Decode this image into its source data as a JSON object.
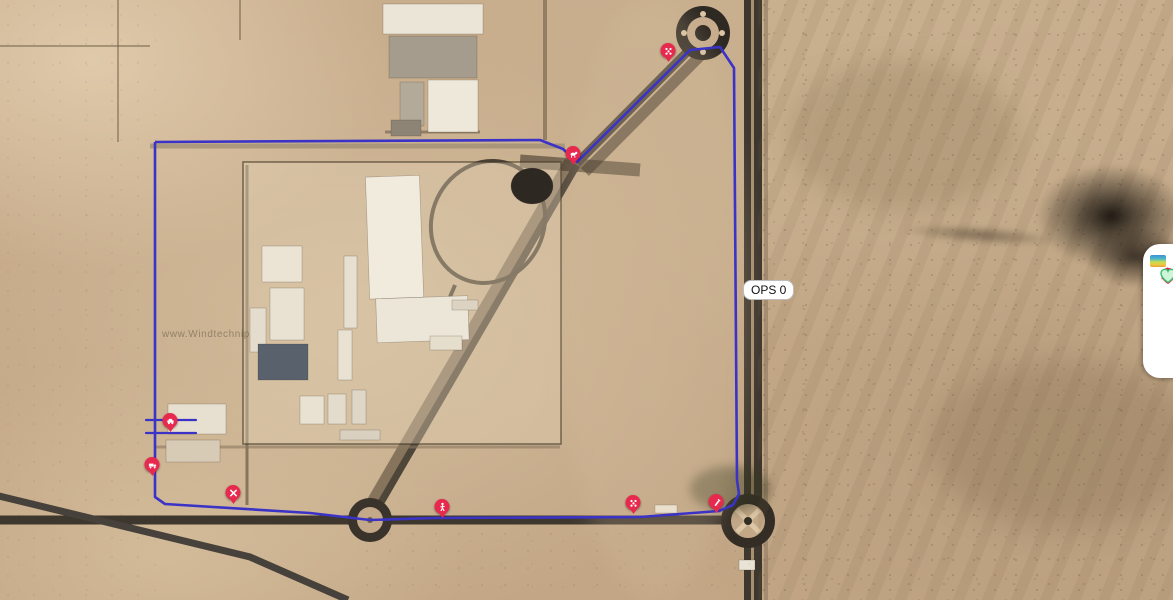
{
  "map": {
    "route_label": "OPS 0",
    "watermark": "www.Windtechnip",
    "route_color": "#3b33c6",
    "marker_color": "#e8294e",
    "route": {
      "loop": [
        [
          155,
          142
        ],
        [
          540,
          140
        ],
        [
          563,
          149
        ],
        [
          577,
          162
        ],
        [
          690,
          50
        ],
        [
          720,
          47
        ],
        [
          734,
          68
        ],
        [
          737,
          480
        ],
        [
          739,
          494
        ],
        [
          733,
          505
        ],
        [
          719,
          511
        ],
        [
          640,
          517
        ],
        [
          434,
          518
        ],
        [
          370,
          520
        ],
        [
          310,
          513
        ],
        [
          165,
          504
        ],
        [
          155,
          497
        ],
        [
          155,
          142
        ]
      ],
      "spurs": [
        [
          [
            146,
            420
          ],
          [
            196,
            420
          ]
        ],
        [
          [
            146,
            433
          ],
          [
            196,
            433
          ]
        ]
      ]
    },
    "markers": [
      {
        "name": "marker-north-roundabout",
        "icon": "cluster",
        "x": 668,
        "y": 62
      },
      {
        "name": "marker-route-corner",
        "icon": "animal",
        "x": 573,
        "y": 165
      },
      {
        "name": "marker-west-site",
        "icon": "car",
        "x": 170,
        "y": 432
      },
      {
        "name": "marker-west-road",
        "icon": "truck",
        "x": 152,
        "y": 476
      },
      {
        "name": "marker-southwest-corner",
        "icon": "tools",
        "x": 233,
        "y": 504
      },
      {
        "name": "marker-south-road",
        "icon": "pedestrian",
        "x": 442,
        "y": 518
      },
      {
        "name": "marker-southeast-road",
        "icon": "cluster",
        "x": 633,
        "y": 514
      },
      {
        "name": "marker-south-roundabout",
        "icon": "pen",
        "x": 716,
        "y": 513
      }
    ]
  },
  "side_panel": {
    "items": [
      {
        "name": "alerts",
        "icon": "alert-pin-icon",
        "badge": "9"
      },
      {
        "name": "notifications",
        "icon": "bell-icon",
        "badge": "1"
      },
      {
        "name": "heatmap",
        "icon": "heatmap-icon",
        "badge": ""
      },
      {
        "name": "health",
        "icon": "heart-icon",
        "badge": ""
      }
    ]
  },
  "colors": {
    "alert_red": "#e8294e",
    "bell_red": "#e51d38",
    "heart_green_stroke": "#3fbf72",
    "heart_green_fill": "#cdf6d8"
  }
}
